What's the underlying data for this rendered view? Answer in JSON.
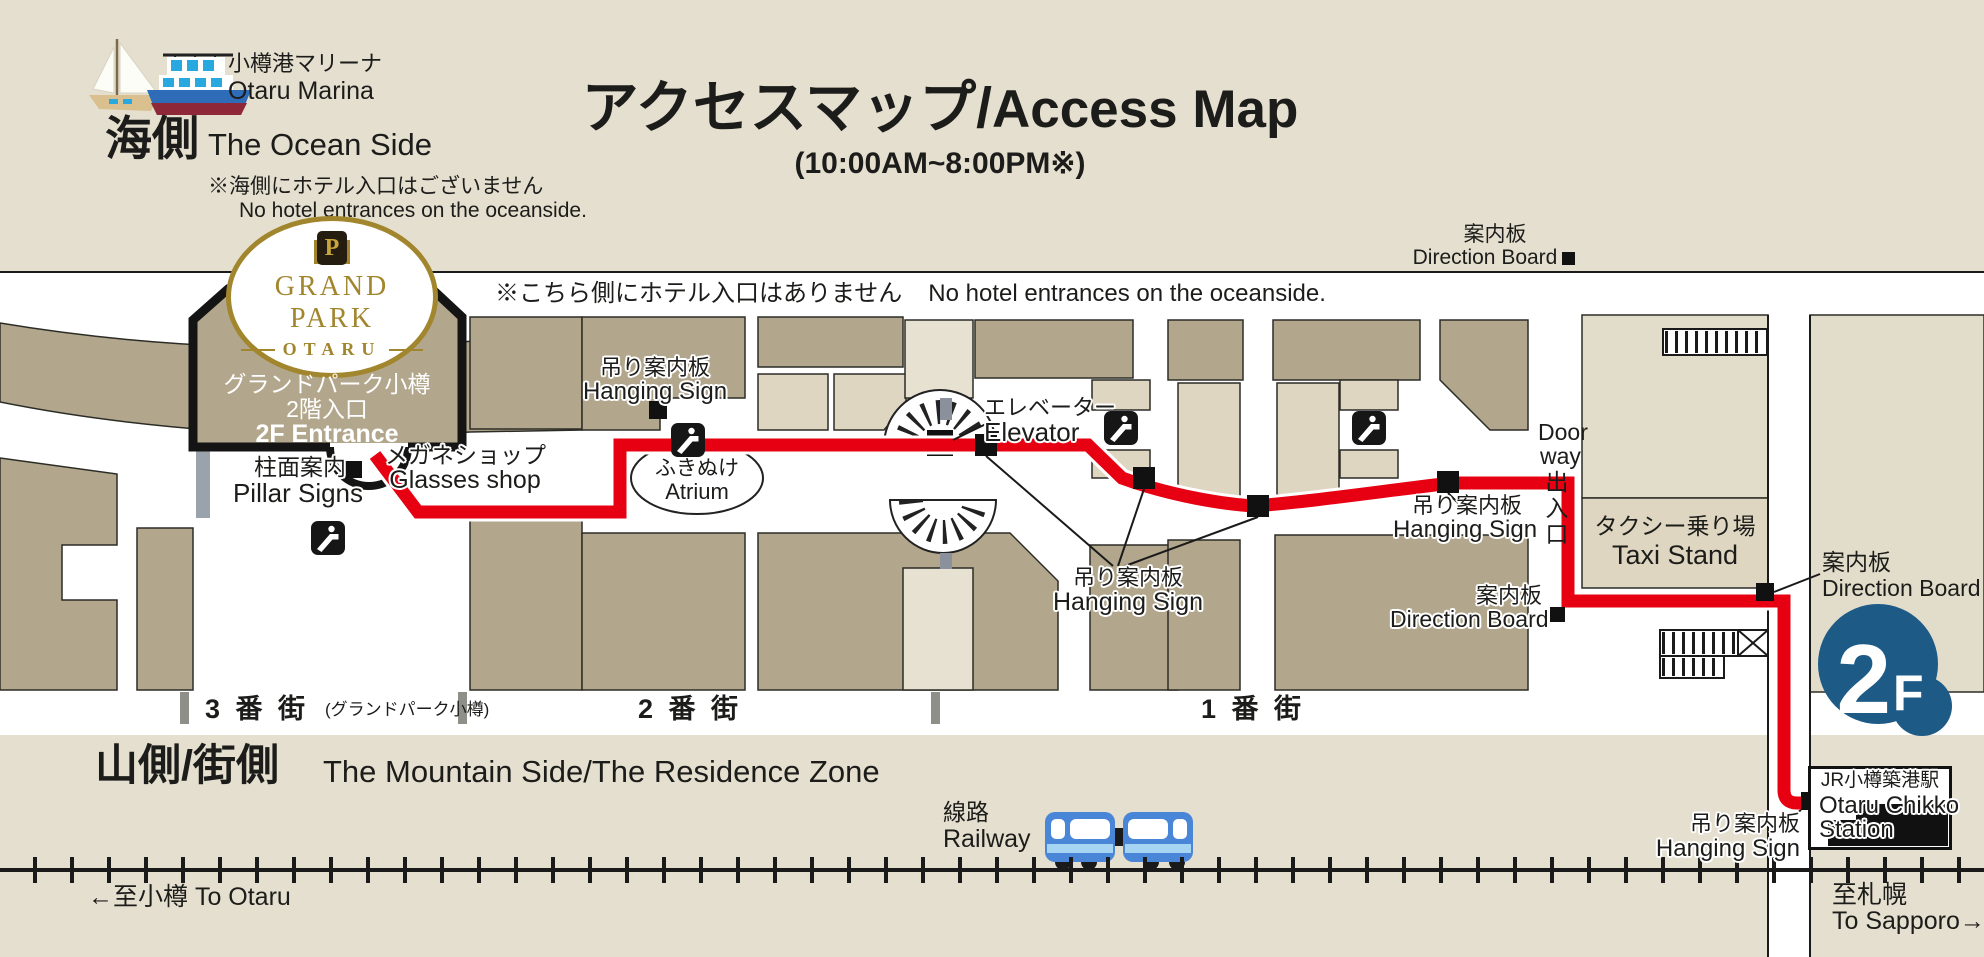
{
  "header": {
    "marina_jp": "小樽港マリーナ",
    "marina_en": "Otaru Marina",
    "side_jp": "海側",
    "side_en": "The Ocean Side",
    "note_jp": "※海側にホテル入口はございません",
    "note_en": "No hotel entrances on the oceanside.",
    "title_jp": "アクセスマップ/",
    "title_en": "Access Map",
    "hours": "(10:00AM~8:00PM※)"
  },
  "map": {
    "top_note_jp": "※こちら側にホテル入口はありません",
    "top_note_en": "No hotel entrances on the oceanside.",
    "direction_board_top": {
      "jp": "案内板",
      "en": "Direction Board"
    },
    "hotel": {
      "crest": "P",
      "name": "GRAND PARK",
      "city": "OTARU",
      "jp1": "グランドパーク小樽",
      "jp2": "2階入口",
      "en": "2F Entrance"
    },
    "pillar": {
      "jp": "柱面案内",
      "en": "Pillar Signs"
    },
    "glasses": {
      "jp": "メガネショップ",
      "en": "Glasses shop"
    },
    "hanging_atrium": {
      "jp": "吊り案内板",
      "en": "Hanging Sign"
    },
    "atrium": {
      "jp": "ふきぬけ",
      "en": "Atrium"
    },
    "elevator": {
      "jp": "エレベーター",
      "en": "Elevator"
    },
    "hanging_center": {
      "jp": "吊り案内板",
      "en": "Hanging Sign"
    },
    "hanging_right": {
      "jp": "吊り案内板",
      "en": "Hanging Sign"
    },
    "direction_board_center": {
      "jp": "案内板",
      "en": "Direction Board"
    },
    "doorway": {
      "en_line1": "Door",
      "en_line2": "way",
      "jp": "出入口"
    },
    "taxi": {
      "jp": "タクシー乗り場",
      "en": "Taxi Stand"
    },
    "direction_board_right": {
      "jp": "案内板",
      "en": "Direction Board"
    },
    "floor_badge": {
      "big": "2",
      "small": "F"
    },
    "station": {
      "jp": "JR小樽築港駅",
      "en1": "Otaru Chikko",
      "en2": "Station"
    },
    "hanging_station": {
      "jp": "吊り案内板",
      "en": "Hanging Sign"
    }
  },
  "streets": {
    "s3": "3 番 街",
    "s3_sub": "(グランドパーク小樽)",
    "s2": "2 番 街",
    "s1": "1 番 街"
  },
  "footer": {
    "mountain_jp": "山側/街側",
    "mountain_en": "The Mountain Side/The Residence Zone",
    "railway_jp": "線路",
    "railway_en": "Railway",
    "to_otaru": "←至小樽 To Otaru",
    "to_sapporo_jp": "至札幌",
    "to_sapporo_en": "To Sapporo→"
  },
  "colors": {
    "route_red": "#e60012",
    "badge_blue": "#1d5a86",
    "logo_gold": "#a1862e",
    "block_dark": "#b2a78c",
    "block_light": "#ded6c0",
    "background": "#e5dfcf"
  }
}
